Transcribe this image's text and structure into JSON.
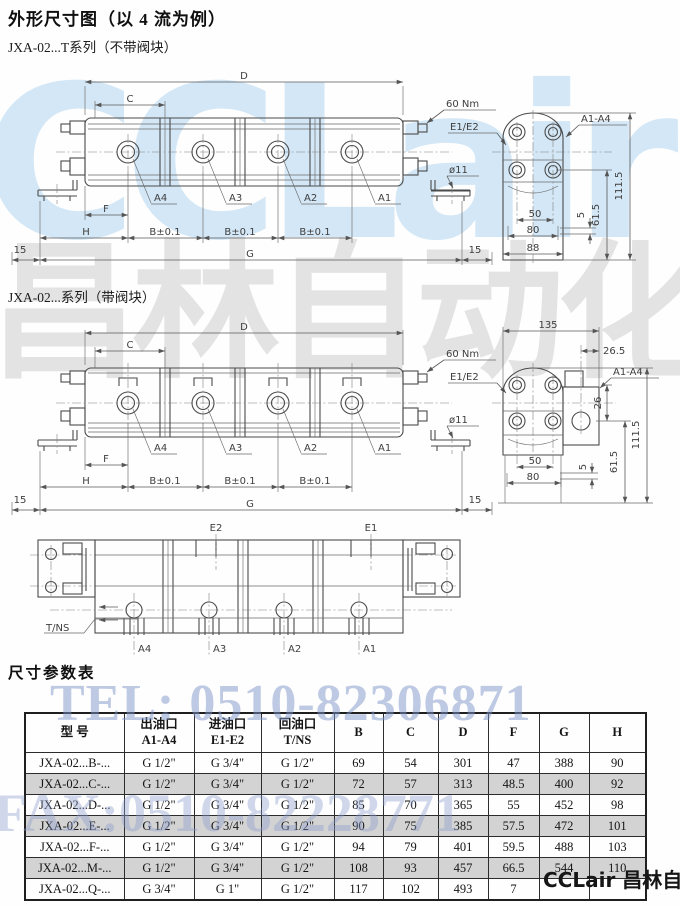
{
  "page": {
    "title": "外形尺寸图（以 4 流为例）",
    "fig1_subtitle": "JXA-02...T系列（不带阀块）",
    "fig2_subtitle": "JXA-02...系列（带阀块）",
    "table_title": "尺寸参数表"
  },
  "drawing_labels": {
    "fig1": {
      "D": "D",
      "C": "C",
      "F": "F",
      "H": "H",
      "B1": "B±0.1",
      "B2": "B±0.1",
      "B3": "B±0.1",
      "G": "G",
      "left15": "15",
      "right15": "15",
      "torque": "60 Nm",
      "eports": "E1/E2",
      "aports": "A1-A4",
      "dia": "ø11",
      "a4": "A4",
      "a3": "A3",
      "a2": "A2",
      "a1": "A1",
      "h111": "111.5",
      "h61": "61.5",
      "h5": "5",
      "w50": "50",
      "w80": "80",
      "w88": "88"
    },
    "fig2": {
      "D": "D",
      "C": "C",
      "F": "F",
      "H": "H",
      "B1": "B±0.1",
      "B2": "B±0.1",
      "B3": "B±0.1",
      "G": "G",
      "left15": "15",
      "right15": "15",
      "torque": "60 Nm",
      "eports": "E1/E2",
      "aports": "A1-A4",
      "dia": "ø11",
      "a4": "A4",
      "a3": "A3",
      "a2": "A2",
      "a1": "A1",
      "w135": "135",
      "w26_5": "26.5",
      "h26": "26",
      "h111": "111.5",
      "h61": "61.5",
      "h5": "5",
      "w50": "50",
      "w80": "80"
    },
    "fig3": {
      "e2": "E2",
      "e1": "E1",
      "tns": "T/NS",
      "a4": "A4",
      "a3": "A3",
      "a2": "A2",
      "a1": "A1"
    }
  },
  "table": {
    "headers": {
      "model": "型    号",
      "outlet_cn": "出油口",
      "outlet_en": "A1-A4",
      "inlet_cn": "进油口",
      "inlet_en": "E1-E2",
      "return_cn": "回油口",
      "return_en": "T/NS",
      "b": "B",
      "c": "C",
      "d": "D",
      "f": "F",
      "g": "G",
      "h": "H"
    },
    "rows": [
      {
        "model": "JXA-02...B-...",
        "outlet": "G 1/2\"",
        "inlet": "G 3/4\"",
        "ret": "G 1/2\"",
        "b": "69",
        "c": "54",
        "d": "301",
        "f": "47",
        "g": "388",
        "h": "90"
      },
      {
        "model": "JXA-02...C-...",
        "outlet": "G 1/2\"",
        "inlet": "G 3/4\"",
        "ret": "G 1/2\"",
        "b": "72",
        "c": "57",
        "d": "313",
        "f": "48.5",
        "g": "400",
        "h": "92"
      },
      {
        "model": "JXA-02...D-...",
        "outlet": "G 1/2\"",
        "inlet": "G 3/4\"",
        "ret": "G 1/2\"",
        "b": "85",
        "c": "70",
        "d": "365",
        "f": "55",
        "g": "452",
        "h": "98"
      },
      {
        "model": "JXA-02...E-...",
        "outlet": "G 1/2\"",
        "inlet": "G 3/4\"",
        "ret": "G 1/2\"",
        "b": "90",
        "c": "75",
        "d": "385",
        "f": "57.5",
        "g": "472",
        "h": "101"
      },
      {
        "model": "JXA-02...F-...",
        "outlet": "G 1/2\"",
        "inlet": "G 3/4\"",
        "ret": "G 1/2\"",
        "b": "94",
        "c": "79",
        "d": "401",
        "f": "59.5",
        "g": "488",
        "h": "103"
      },
      {
        "model": "JXA-02...M-...",
        "outlet": "G 1/2\"",
        "inlet": "G 3/4\"",
        "ret": "G 1/2\"",
        "b": "108",
        "c": "93",
        "d": "457",
        "f": "66.5",
        "g": "544",
        "h": "110"
      },
      {
        "model": "JXA-02...Q-...",
        "outlet": "G 3/4\"",
        "inlet": "G 1\"",
        "ret": "G 1/2\"",
        "b": "117",
        "c": "102",
        "d": "493",
        "f": "7",
        "g": "",
        "h": ""
      }
    ]
  },
  "watermarks": {
    "brand_latin": "CCLair",
    "brand_cn": "昌林自动化",
    "tel": "TEL: 0510-82306871",
    "fax": "FAX:0510-82228771",
    "footer": "CCLair 昌林自动化"
  }
}
